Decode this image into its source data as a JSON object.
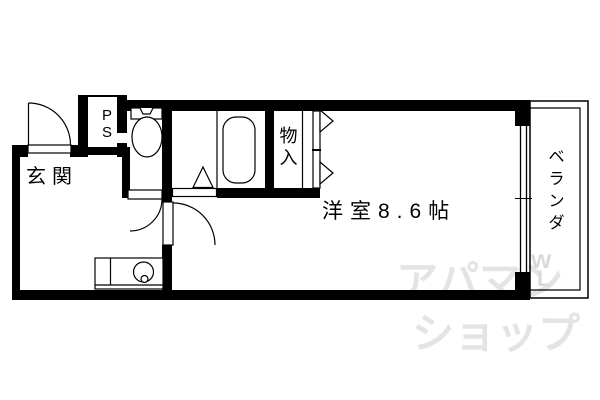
{
  "floorplan": {
    "labels": {
      "entrance": "玄関",
      "pipe_space": "PS",
      "storage": "物入",
      "main_room": "洋室8.6帖",
      "veranda": "ベランダ"
    },
    "colors": {
      "wall": "#000000",
      "line": "#000000",
      "background": "#ffffff",
      "watermark": "#e4e4e4"
    }
  },
  "watermark": {
    "line1": "アパマン",
    "line2": "ショップ",
    "mark_top": "w",
    "mark_bottom": "L"
  }
}
